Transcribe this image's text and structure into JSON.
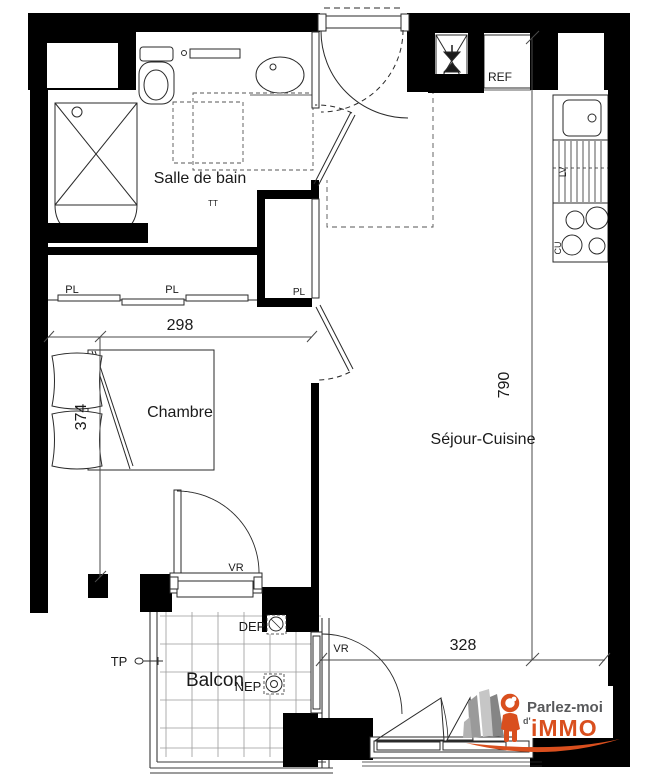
{
  "plan": {
    "rooms": {
      "salle_de_bain": "Salle de bain",
      "chambre": "Chambre",
      "sejour_cuisine": "Séjour-Cuisine",
      "balcon": "Balcon"
    },
    "labels": {
      "pl_left": "PL",
      "pl_mid": "PL",
      "pl_closet": "PL",
      "ref": "REF",
      "vr_chambre": "VR",
      "vr_sejour": "VR",
      "tp": "TP",
      "dep": "DEP",
      "nep": "NEP",
      "tt": "TT",
      "lv": "LV",
      "cu": "CU"
    },
    "dimensions": {
      "chambre_largeur": "298",
      "chambre_profondeur": "374",
      "sejour_hauteur": "790",
      "sejour_largeur": "328"
    }
  },
  "logo": {
    "line1": "Parlez-moi",
    "apostrophe": "d'",
    "line2": "iMMO",
    "colors": {
      "orange": "#d94f1e",
      "gray": "#58595b"
    }
  },
  "colors": {
    "wall": "#000000",
    "line": "#2a2a2a",
    "dim": "#4a4a4a",
    "grid": "#9a9a9a"
  }
}
